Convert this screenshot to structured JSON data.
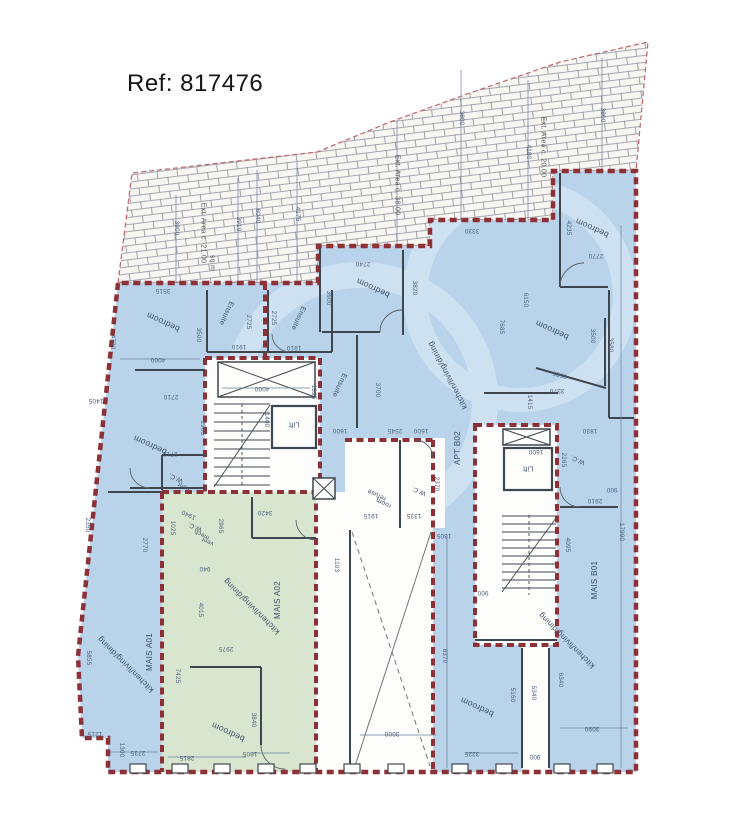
{
  "header": {
    "ref": "Ref: 817476"
  },
  "colors": {
    "room_blue": "#b9d4ea",
    "room_green": "#d9e6cf",
    "boundary_red": "#8d3138",
    "wall": "#3f474e",
    "dim_text": "#4a5d7d",
    "label_text": "#3a4d66",
    "hatch_line": "#8a9097"
  },
  "apartments": [
    "MAIS A01",
    "MAIS A02",
    "APT B02",
    "MAIS B01"
  ],
  "room_labels": [
    {
      "t": "bedroom",
      "x": 163,
      "y": 322,
      "r": 205
    },
    {
      "t": "Ensuite",
      "x": 226,
      "y": 313,
      "r": 115,
      "fs": 7
    },
    {
      "t": "Ensuite",
      "x": 298,
      "y": 318,
      "r": 115,
      "fs": 7
    },
    {
      "t": "bedroom",
      "x": 150,
      "y": 445,
      "r": 205
    },
    {
      "t": "bedroom",
      "x": 373,
      "y": 288,
      "r": 205
    },
    {
      "t": "Ensuite",
      "x": 339,
      "y": 385,
      "r": 115,
      "fs": 7
    },
    {
      "t": "kitchen/living/dining",
      "x": 448,
      "y": 375,
      "r": 242,
      "fs": 8
    },
    {
      "t": "APT B02",
      "x": 458,
      "y": 448,
      "r": 270,
      "fs": 8
    },
    {
      "t": "bedroom",
      "x": 592,
      "y": 228,
      "r": 205
    },
    {
      "t": "bedroom",
      "x": 552,
      "y": 330,
      "r": 205
    },
    {
      "t": "W.C.",
      "x": 419,
      "y": 490,
      "r": 205,
      "fs": 6.5
    },
    {
      "t": "refuse",
      "x": 377,
      "y": 494,
      "r": 205,
      "fs": 6.5
    },
    {
      "t": "room",
      "x": 384,
      "y": 502,
      "r": 205,
      "fs": 6.5
    },
    {
      "t": "W.C.",
      "x": 578,
      "y": 459,
      "r": 205,
      "fs": 6.5
    },
    {
      "t": "Lift",
      "x": 294,
      "y": 424,
      "r": 180,
      "fs": 7
    },
    {
      "t": "Lift",
      "x": 528,
      "y": 468,
      "r": 180,
      "fs": 7
    },
    {
      "t": "MAIS A01",
      "x": 150,
      "y": 652,
      "r": 270,
      "fs": 8
    },
    {
      "t": "kitchen/living/dining",
      "x": 126,
      "y": 664,
      "r": 225,
      "fs": 8
    },
    {
      "t": "MAIS A02",
      "x": 278,
      "y": 600,
      "r": 270,
      "fs": 8
    },
    {
      "t": "kitchen/living/dining",
      "x": 252,
      "y": 606,
      "r": 225,
      "fs": 8
    },
    {
      "t": "bedroom",
      "x": 228,
      "y": 732,
      "r": 205
    },
    {
      "t": "W.C.",
      "x": 195,
      "y": 526,
      "r": 205,
      "fs": 6.5
    },
    {
      "t": "mech",
      "x": 202,
      "y": 534,
      "r": 205,
      "fs": 6
    },
    {
      "t": "vent",
      "x": 208,
      "y": 541,
      "r": 205,
      "fs": 6
    },
    {
      "t": "W.C.",
      "x": 176,
      "y": 477,
      "r": 205,
      "fs": 6.5
    },
    {
      "t": "vent",
      "x": 184,
      "y": 486,
      "r": 205,
      "fs": 6
    },
    {
      "t": "MAIS B01",
      "x": 595,
      "y": 580,
      "r": 270,
      "fs": 8
    },
    {
      "t": "kitchen/living/dining",
      "x": 567,
      "y": 640,
      "r": 225,
      "fs": 8
    },
    {
      "t": "bedroom",
      "x": 477,
      "y": 707,
      "r": 205
    }
  ],
  "area_labels": [
    {
      "t": "Ext. Area c. 21.00",
      "x": 203,
      "y": 233,
      "r": 90
    },
    {
      "t": "sq.m",
      "x": 212,
      "y": 263,
      "r": 90
    },
    {
      "t": "Ext. Area c. 38.00",
      "x": 397,
      "y": 185,
      "r": 90
    },
    {
      "t": "Ext. Area c. 20.00",
      "x": 543,
      "y": 147,
      "r": 90
    }
  ],
  "dim_labels": [
    {
      "t": "3900",
      "x": 176,
      "y": 228,
      "r": 90
    },
    {
      "t": "3910",
      "x": 238,
      "y": 224,
      "r": 90
    },
    {
      "t": "6040",
      "x": 257,
      "y": 216,
      "r": 90
    },
    {
      "t": "4175",
      "x": 297,
      "y": 214,
      "r": 90
    },
    {
      "t": "3800",
      "x": 461,
      "y": 118,
      "r": 90
    },
    {
      "t": "4180",
      "x": 528,
      "y": 152,
      "r": 90
    },
    {
      "t": "3800",
      "x": 602,
      "y": 115,
      "r": 90
    },
    {
      "t": "3515",
      "x": 163,
      "y": 290,
      "r": 180
    },
    {
      "t": "4730",
      "x": 112,
      "y": 342,
      "r": 90
    },
    {
      "t": "3500",
      "x": 198,
      "y": 335,
      "r": 90
    },
    {
      "t": "2725",
      "x": 248,
      "y": 322,
      "r": 90
    },
    {
      "t": "2725",
      "x": 273,
      "y": 318,
      "r": 90
    },
    {
      "t": "1910",
      "x": 239,
      "y": 346,
      "r": 180
    },
    {
      "t": "1910",
      "x": 294,
      "y": 347,
      "r": 180
    },
    {
      "t": "4000",
      "x": 158,
      "y": 359,
      "r": 180
    },
    {
      "t": "2710",
      "x": 171,
      "y": 396,
      "r": 180
    },
    {
      "t": "1405",
      "x": 96,
      "y": 400,
      "r": 180
    },
    {
      "t": "2905",
      "x": 202,
      "y": 428,
      "r": 90
    },
    {
      "t": "2710",
      "x": 170,
      "y": 453,
      "r": 180
    },
    {
      "t": "2740",
      "x": 363,
      "y": 263,
      "r": 180
    },
    {
      "t": "3600",
      "x": 328,
      "y": 298,
      "r": 90
    },
    {
      "t": "3820",
      "x": 414,
      "y": 288,
      "r": 90
    },
    {
      "t": "3330",
      "x": 472,
      "y": 230,
      "r": 180
    },
    {
      "t": "6150",
      "x": 525,
      "y": 300,
      "r": 90
    },
    {
      "t": "7685",
      "x": 501,
      "y": 327,
      "r": 90
    },
    {
      "t": "1895",
      "x": 313,
      "y": 392,
      "r": 90
    },
    {
      "t": "3700",
      "x": 377,
      "y": 390,
      "r": 90
    },
    {
      "t": "4000",
      "x": 262,
      "y": 388,
      "r": 180
    },
    {
      "t": "1400",
      "x": 266,
      "y": 420,
      "r": 90
    },
    {
      "t": "1600",
      "x": 340,
      "y": 430,
      "r": 180
    },
    {
      "t": "2545",
      "x": 395,
      "y": 430,
      "r": 180
    },
    {
      "t": "1600",
      "x": 421,
      "y": 430,
      "r": 180
    },
    {
      "t": "4235",
      "x": 568,
      "y": 228,
      "r": 90
    },
    {
      "t": "2770",
      "x": 596,
      "y": 255,
      "r": 180
    },
    {
      "t": "3500",
      "x": 592,
      "y": 336,
      "r": 90
    },
    {
      "t": "3585",
      "x": 560,
      "y": 374,
      "r": 195
    },
    {
      "t": "3370",
      "x": 557,
      "y": 390,
      "r": 180
    },
    {
      "t": "1415",
      "x": 529,
      "y": 402,
      "r": 90
    },
    {
      "t": "3580",
      "x": 610,
      "y": 345,
      "r": 90
    },
    {
      "t": "1830",
      "x": 590,
      "y": 430,
      "r": 180
    },
    {
      "t": "2265",
      "x": 563,
      "y": 460,
      "r": 90
    },
    {
      "t": "1600",
      "x": 536,
      "y": 451,
      "r": 180
    },
    {
      "t": "900",
      "x": 612,
      "y": 489,
      "r": 180
    },
    {
      "t": "2910",
      "x": 595,
      "y": 500,
      "r": 180
    },
    {
      "t": "4095",
      "x": 567,
      "y": 545,
      "r": 90
    },
    {
      "t": "17990",
      "x": 621,
      "y": 532,
      "r": 90
    },
    {
      "t": "2350",
      "x": 87,
      "y": 525,
      "r": 90
    },
    {
      "t": "2770",
      "x": 144,
      "y": 545,
      "r": 90
    },
    {
      "t": "1025",
      "x": 172,
      "y": 528,
      "r": 90
    },
    {
      "t": "1940",
      "x": 189,
      "y": 514,
      "r": 205
    },
    {
      "t": "2965",
      "x": 220,
      "y": 526,
      "r": 90
    },
    {
      "t": "3420",
      "x": 265,
      "y": 512,
      "r": 180
    },
    {
      "t": "940",
      "x": 205,
      "y": 568,
      "r": 180
    },
    {
      "t": "4015",
      "x": 200,
      "y": 610,
      "r": 90
    },
    {
      "t": "2975",
      "x": 226,
      "y": 648,
      "r": 180
    },
    {
      "t": "5855",
      "x": 88,
      "y": 658,
      "r": 90
    },
    {
      "t": "7425",
      "x": 177,
      "y": 676,
      "r": 90
    },
    {
      "t": "1215",
      "x": 95,
      "y": 733,
      "r": 180
    },
    {
      "t": "2735",
      "x": 138,
      "y": 752,
      "r": 180
    },
    {
      "t": "1300",
      "x": 121,
      "y": 750,
      "r": 90
    },
    {
      "t": "2815",
      "x": 187,
      "y": 757,
      "r": 180
    },
    {
      "t": "1805",
      "x": 250,
      "y": 753,
      "r": 180
    },
    {
      "t": "3840",
      "x": 253,
      "y": 720,
      "r": 90
    },
    {
      "t": "1915",
      "x": 371,
      "y": 515,
      "r": 180
    },
    {
      "t": "1335",
      "x": 414,
      "y": 515,
      "r": 180
    },
    {
      "t": "2370",
      "x": 436,
      "y": 484,
      "r": 90
    },
    {
      "t": "1305",
      "x": 444,
      "y": 535,
      "r": 180
    },
    {
      "t": "1103",
      "x": 336,
      "y": 565,
      "r": 90
    },
    {
      "t": "8370",
      "x": 444,
      "y": 656,
      "r": 90
    },
    {
      "t": "3000",
      "x": 392,
      "y": 733,
      "r": 180
    },
    {
      "t": "5160",
      "x": 512,
      "y": 695,
      "r": 90
    },
    {
      "t": "5340",
      "x": 533,
      "y": 693,
      "r": 90
    },
    {
      "t": "900",
      "x": 535,
      "y": 756,
      "r": 180
    },
    {
      "t": "3225",
      "x": 472,
      "y": 753,
      "r": 180
    },
    {
      "t": "6340",
      "x": 560,
      "y": 680,
      "r": 90
    },
    {
      "t": "3090",
      "x": 592,
      "y": 728,
      "r": 180
    },
    {
      "t": "900",
      "x": 483,
      "y": 592,
      "r": 180
    }
  ]
}
